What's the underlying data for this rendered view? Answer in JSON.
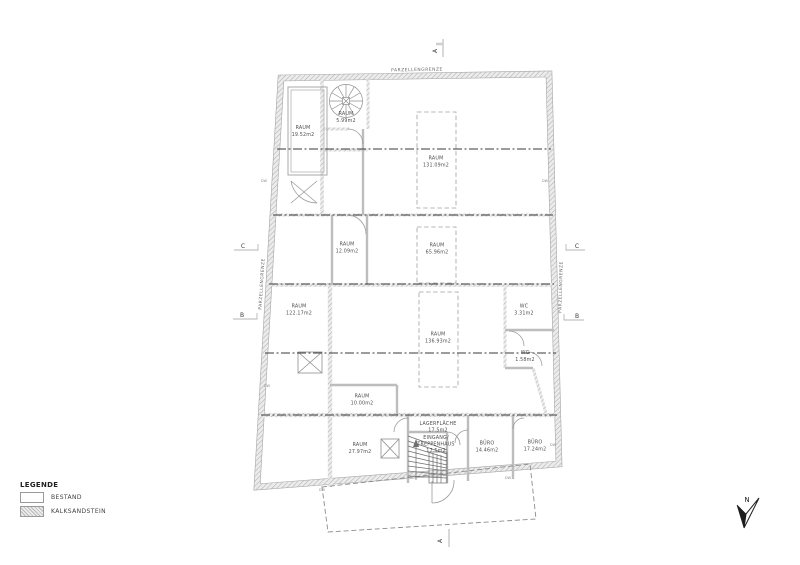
{
  "drawing": {
    "boundary_label": "PARZELLENGRENZE",
    "north_label": "N",
    "dw_label": "DW"
  },
  "section_markers": {
    "a": "A",
    "b": "B",
    "c": "C"
  },
  "rooms": [
    {
      "name": "RAUM",
      "area": "19.52m2"
    },
    {
      "name": "RAUM",
      "area": "5.99m2"
    },
    {
      "name": "RAUM",
      "area": "131.09m2"
    },
    {
      "name": "RAUM",
      "area": "12.09m2"
    },
    {
      "name": "RAUM",
      "area": "65.96m2"
    },
    {
      "name": "RAUM",
      "area": "122.17m2"
    },
    {
      "name": "WC",
      "area": "3.31m2"
    },
    {
      "name": "RAUM",
      "area": "136.93m2"
    },
    {
      "name": "WC",
      "area": "1.58m2"
    },
    {
      "name": "RAUM",
      "area": "10.00m2"
    },
    {
      "name": "LAGERFLÄCHE",
      "area": "17.5m2"
    },
    {
      "name": "RAUM",
      "area": "27.97m2"
    },
    {
      "line1": "EINGANG/",
      "line2": "TREPPENHAUS",
      "area": "17.5m2"
    },
    {
      "name": "BÜRO",
      "area": "14.46m2"
    },
    {
      "name": "BÜRO",
      "area": "17.24m2"
    }
  ],
  "legend": {
    "title": "LEGENDE",
    "items": [
      {
        "label": "BESTAND"
      },
      {
        "label": "KALKSANDSTEIN"
      }
    ]
  },
  "colors": {
    "background": "#ffffff",
    "wall_hatch": "#b0b0b0",
    "section_line": "#3a3a3a",
    "text": "#4f4f4f"
  }
}
